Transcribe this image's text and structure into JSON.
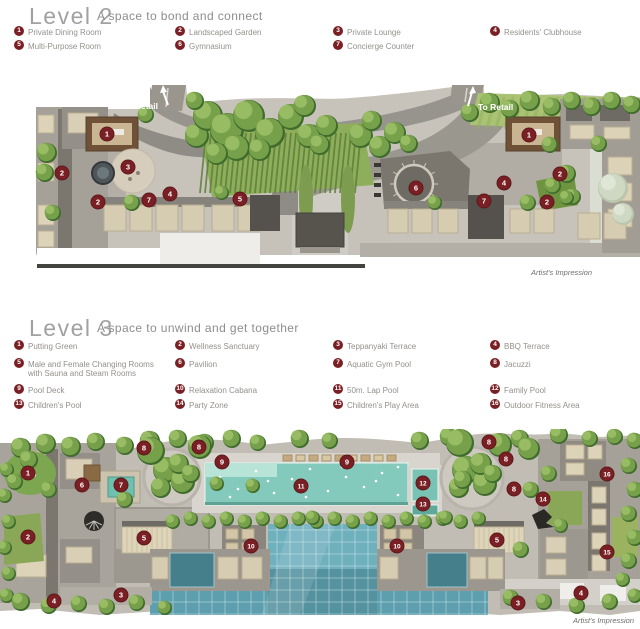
{
  "colors": {
    "badge_bg": "#7a2024",
    "badge_text": "#ffffff",
    "title": "#a2a1a0",
    "subtitle": "#8e8d8b",
    "legend_text": "#95908b",
    "caption": "#6f6d6b",
    "retail_label": "#ffffff",
    "pool_teal": "#83cabc",
    "grid_pool": "#6fb0bd",
    "tree_green": "#76a04a"
  },
  "level2": {
    "title": "Level 2",
    "subtitle": "A space to bond and connect",
    "legend": [
      {
        "num": "1",
        "label": "Private Dining Room"
      },
      {
        "num": "2",
        "label": "Landscaped Garden"
      },
      {
        "num": "3",
        "label": "Private Lounge"
      },
      {
        "num": "4",
        "label": "Residents' Clubhouse"
      },
      {
        "num": "5",
        "label": "Multi-Purpose Room"
      },
      {
        "num": "6",
        "label": "Gymnasium"
      },
      {
        "num": "7",
        "label": "Concierge Counter"
      }
    ],
    "plan": {
      "caption": "Artist's Impression",
      "retail_labels": [
        {
          "text": "To Retail"
        },
        {
          "text": "To Retail"
        }
      ],
      "markers": [
        {
          "n": "1",
          "x": 107,
          "y": 49
        },
        {
          "n": "3",
          "x": 128,
          "y": 82
        },
        {
          "n": "2",
          "x": 62,
          "y": 88
        },
        {
          "n": "2",
          "x": 98,
          "y": 117
        },
        {
          "n": "7",
          "x": 149,
          "y": 115
        },
        {
          "n": "4",
          "x": 170,
          "y": 109
        },
        {
          "n": "5",
          "x": 240,
          "y": 114
        },
        {
          "n": "6",
          "x": 416,
          "y": 103
        },
        {
          "n": "4",
          "x": 504,
          "y": 98
        },
        {
          "n": "7",
          "x": 484,
          "y": 116
        },
        {
          "n": "1",
          "x": 529,
          "y": 50
        },
        {
          "n": "2",
          "x": 560,
          "y": 89
        },
        {
          "n": "2",
          "x": 547,
          "y": 117
        }
      ]
    }
  },
  "level3": {
    "title": "Level 3",
    "subtitle": "A space to unwind and get together",
    "legend": [
      {
        "num": "1",
        "label": "Putting Green"
      },
      {
        "num": "2",
        "label": "Wellness Sanctuary"
      },
      {
        "num": "3",
        "label": "Teppanyaki Terrace"
      },
      {
        "num": "4",
        "label": "BBQ Terrace"
      },
      {
        "num": "5",
        "label": "Male and Female Changing Rooms\nwith Sauna and Steam Rooms"
      },
      {
        "num": "6",
        "label": "Pavilion"
      },
      {
        "num": "7",
        "label": "Aquatic Gym Pool"
      },
      {
        "num": "8",
        "label": "Jacuzzi"
      },
      {
        "num": "9",
        "label": "Pool Deck"
      },
      {
        "num": "10",
        "label": "Relaxation Cabana"
      },
      {
        "num": "11",
        "label": "50m. Lap Pool"
      },
      {
        "num": "12",
        "label": "Family Pool"
      },
      {
        "num": "13",
        "label": "Children's Pool"
      },
      {
        "num": "14",
        "label": "Party Zone"
      },
      {
        "num": "15",
        "label": "Children's Play Area"
      },
      {
        "num": "16",
        "label": "Outdoor Fitness Area"
      }
    ],
    "plan": {
      "caption": "Artist's Impression",
      "markers": [
        {
          "n": "1",
          "x": 28,
          "y": 44
        },
        {
          "n": "2",
          "x": 28,
          "y": 108
        },
        {
          "n": "4",
          "x": 54,
          "y": 172
        },
        {
          "n": "3",
          "x": 121,
          "y": 166
        },
        {
          "n": "6",
          "x": 82,
          "y": 56
        },
        {
          "n": "7",
          "x": 121,
          "y": 56
        },
        {
          "n": "8",
          "x": 144,
          "y": 19
        },
        {
          "n": "8",
          "x": 199,
          "y": 18
        },
        {
          "n": "9",
          "x": 222,
          "y": 33
        },
        {
          "n": "11",
          "x": 301,
          "y": 57
        },
        {
          "n": "5",
          "x": 144,
          "y": 109
        },
        {
          "n": "10",
          "x": 251,
          "y": 117
        },
        {
          "n": "9",
          "x": 347,
          "y": 33
        },
        {
          "n": "12",
          "x": 423,
          "y": 54
        },
        {
          "n": "13",
          "x": 423,
          "y": 75
        },
        {
          "n": "8",
          "x": 489,
          "y": 13
        },
        {
          "n": "8",
          "x": 506,
          "y": 30
        },
        {
          "n": "8",
          "x": 514,
          "y": 60
        },
        {
          "n": "14",
          "x": 543,
          "y": 70
        },
        {
          "n": "16",
          "x": 607,
          "y": 45
        },
        {
          "n": "10",
          "x": 397,
          "y": 117
        },
        {
          "n": "5",
          "x": 497,
          "y": 111
        },
        {
          "n": "15",
          "x": 607,
          "y": 123
        },
        {
          "n": "4",
          "x": 581,
          "y": 164
        },
        {
          "n": "3",
          "x": 518,
          "y": 174
        }
      ]
    }
  }
}
